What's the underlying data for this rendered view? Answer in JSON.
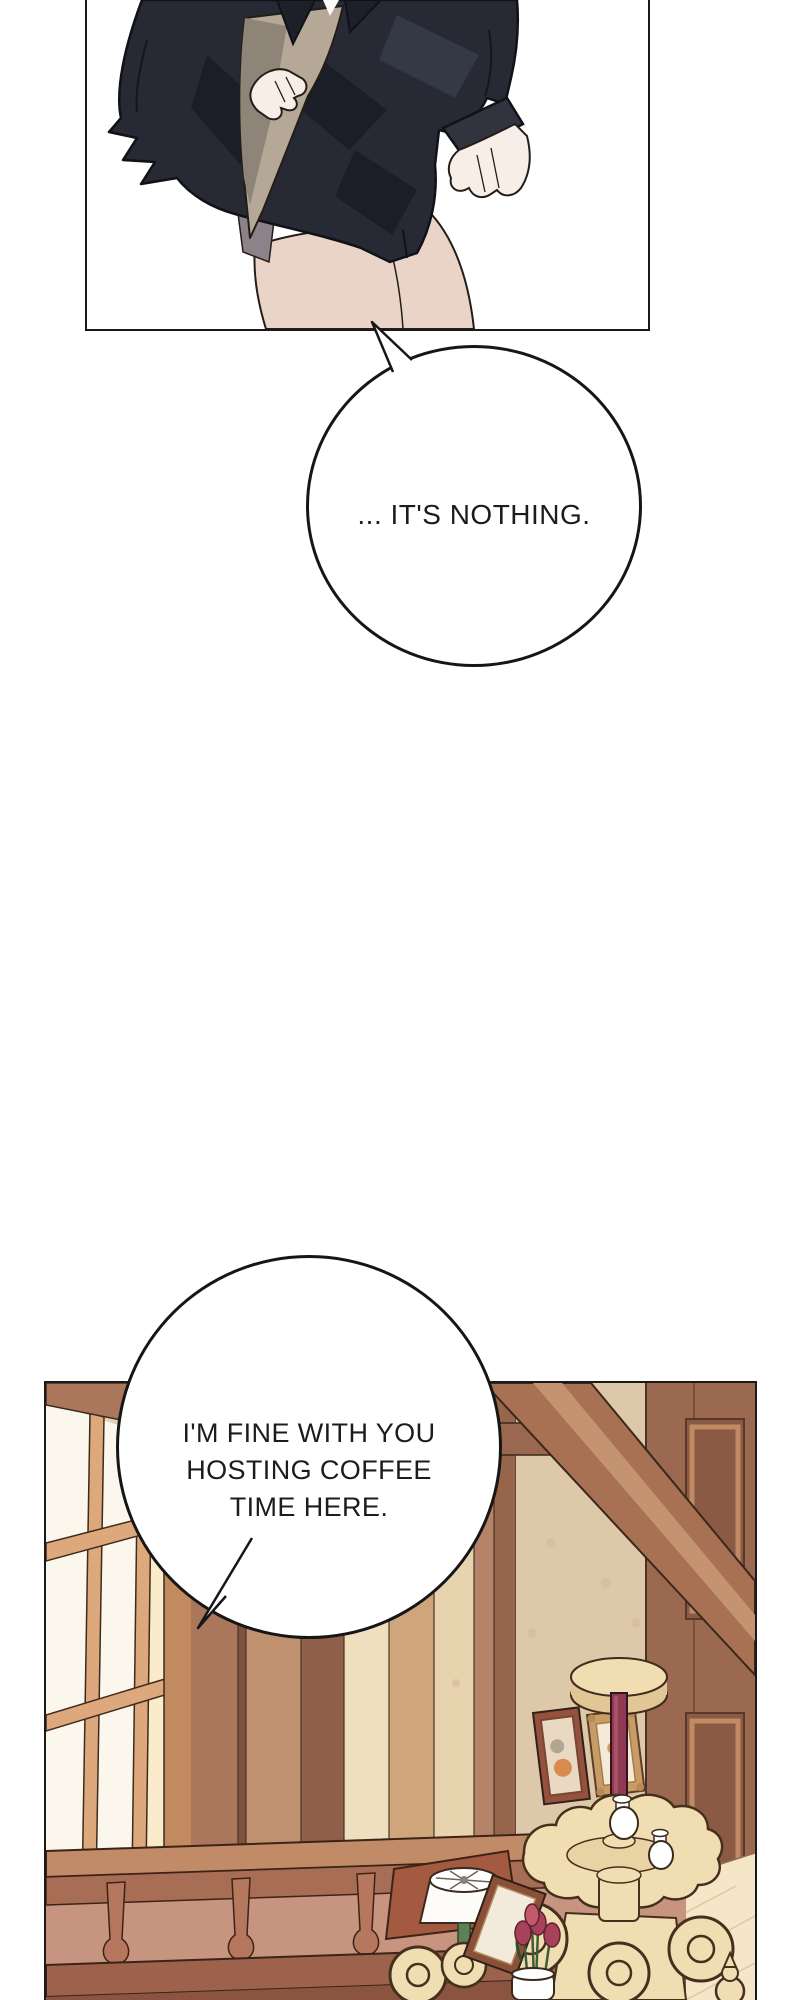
{
  "page": {
    "background": "#ffffff",
    "kind": "comic-page"
  },
  "panel1": {
    "description": "figure in dark navy shirt holding beige cloth, hand on hip"
  },
  "panel2": {
    "description": "wood-panelled room with window, railing, pictures and lamp stand"
  },
  "bubble1": {
    "text": "... IT'S NOTHING."
  },
  "bubble2": {
    "line1": "I'M FINE WITH YOU",
    "line2": "HOSTING COFFEE",
    "line3": "TIME HERE."
  },
  "colors": {
    "ink": "#1a1a1a",
    "shirt": "#272934",
    "shirt_shadow": "#1b1d27",
    "shirt_highlight": "#353845",
    "cloth": "#b5a897",
    "cloth_shadow": "#8f8478",
    "skin": "#f7efe7",
    "leg_skin": "#e9d4c7",
    "under_layer": "#8b8389",
    "pane": "#fbf7ec",
    "pane_glow": "#faeccb",
    "mullion": "#dca87c",
    "wood_light": "#cfa67c",
    "wood_mid": "#aa765c",
    "wood_dark": "#8f5f49",
    "wallpaper": "#e3d1b4",
    "wallpaper_mid": "#ddc9a9",
    "wallpaper_dark": "#d2bc9b",
    "beam": "#a87154",
    "beam_stripe": "#c49370",
    "right_wall": "#9a6950",
    "inset_light": "#c08a62",
    "inset_dark": "#8a5a44",
    "rail_top": "#c18b68",
    "rail_front": "#a86e55",
    "rail_back": "#c79480",
    "baluster": "#b5785f",
    "rail_low": "#9c624c",
    "cream": "#f0ddb1",
    "cream_shade": "#e0c795",
    "maroon": "#8e3a52",
    "floor": "#f4e6c7",
    "table_red": "#a35a40",
    "frame_red": "#96513d",
    "frame_gold": "#c89c66",
    "lamp_white": "#fdfcf8",
    "lamp_green": "#5d8054",
    "tulip": "#a8415a",
    "stem_green": "#3f5c36"
  }
}
